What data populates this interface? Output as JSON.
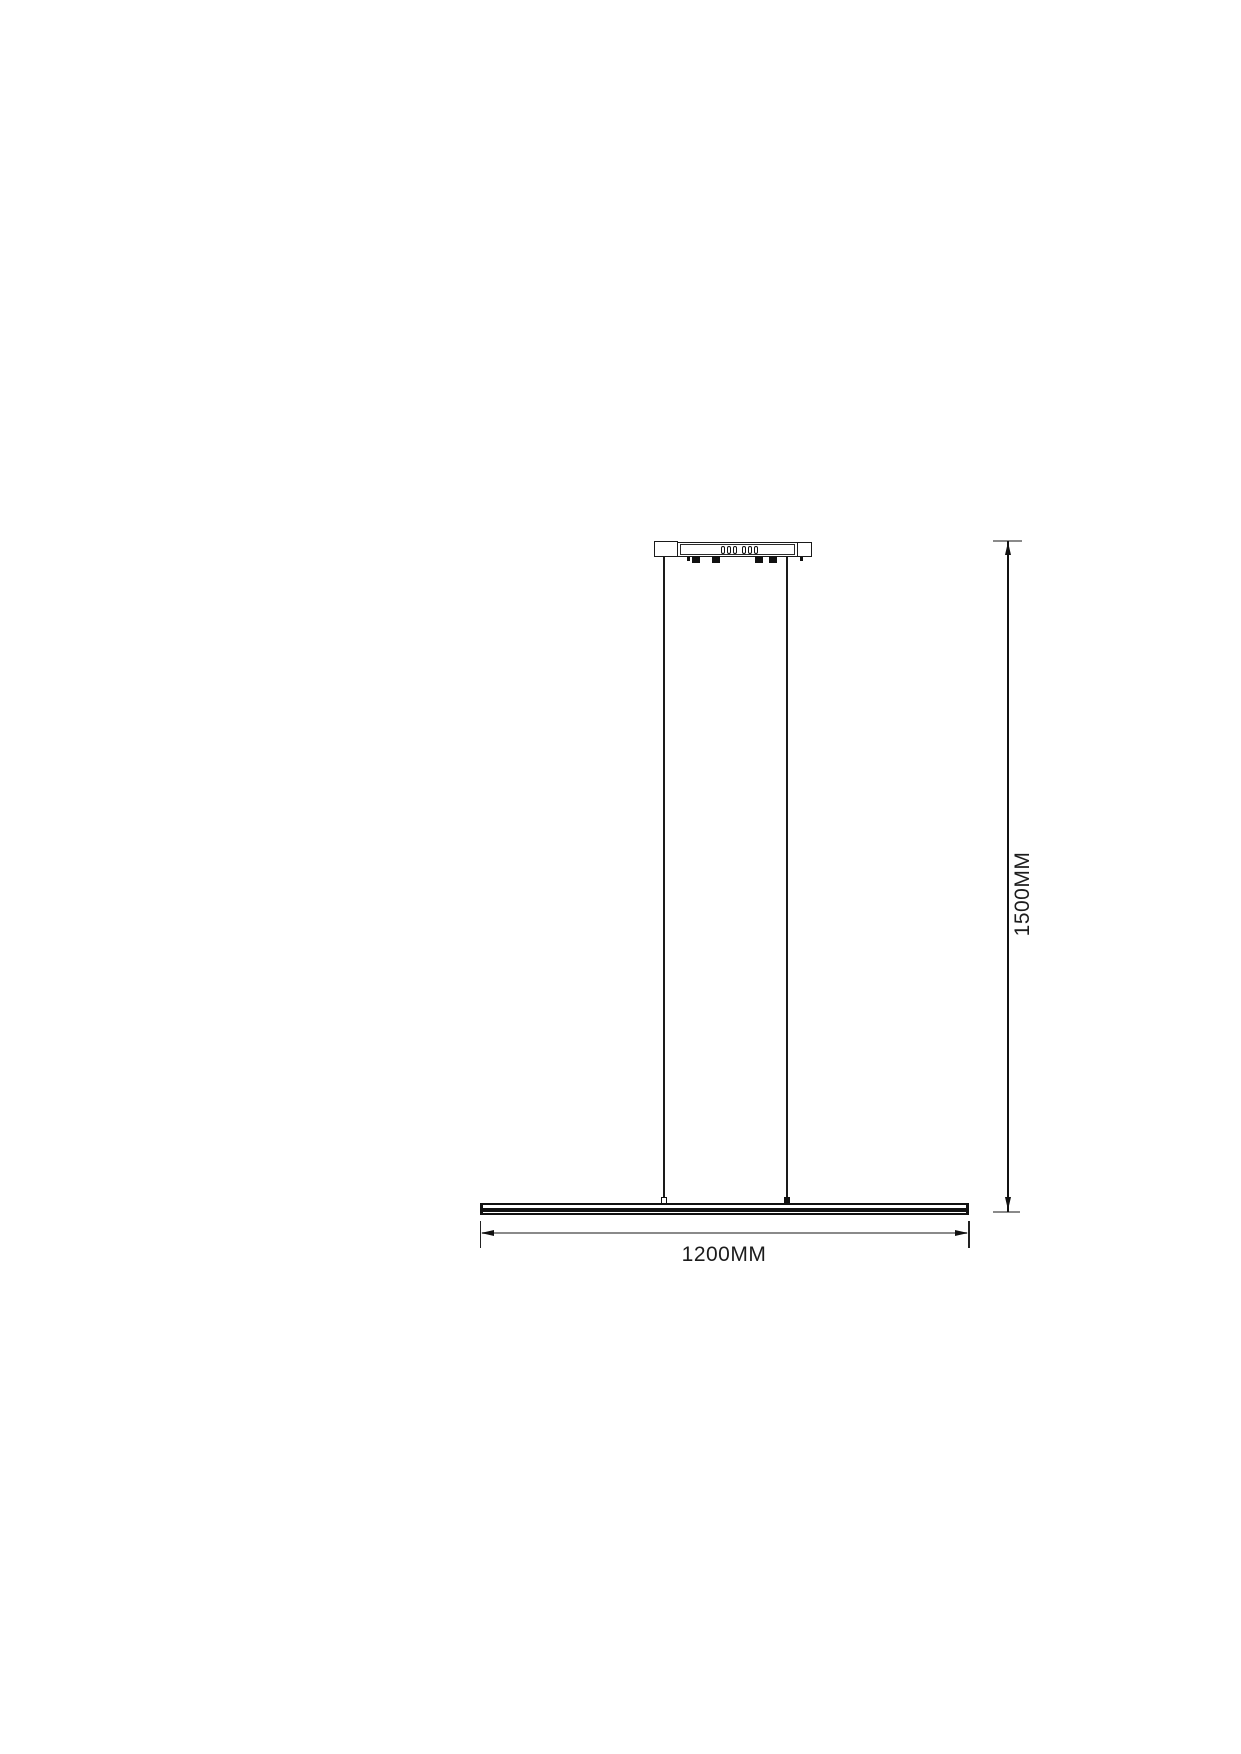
{
  "page": {
    "background": "#ffffff"
  },
  "drawing": {
    "subject": "linear-pendant-light-dimension-diagram",
    "parts": [
      "ceiling-canopy",
      "vent-holes",
      "mounting-tabs",
      "suspension-wire-left",
      "suspension-wire-right",
      "light-bar"
    ],
    "colors": {
      "outline": "#1a1a1a",
      "dimension_line": "#8a8a8a",
      "text": "#1c1c1c"
    }
  },
  "dimensions": {
    "width": {
      "label": "1200MM"
    },
    "height": {
      "label": "1500MM"
    }
  }
}
